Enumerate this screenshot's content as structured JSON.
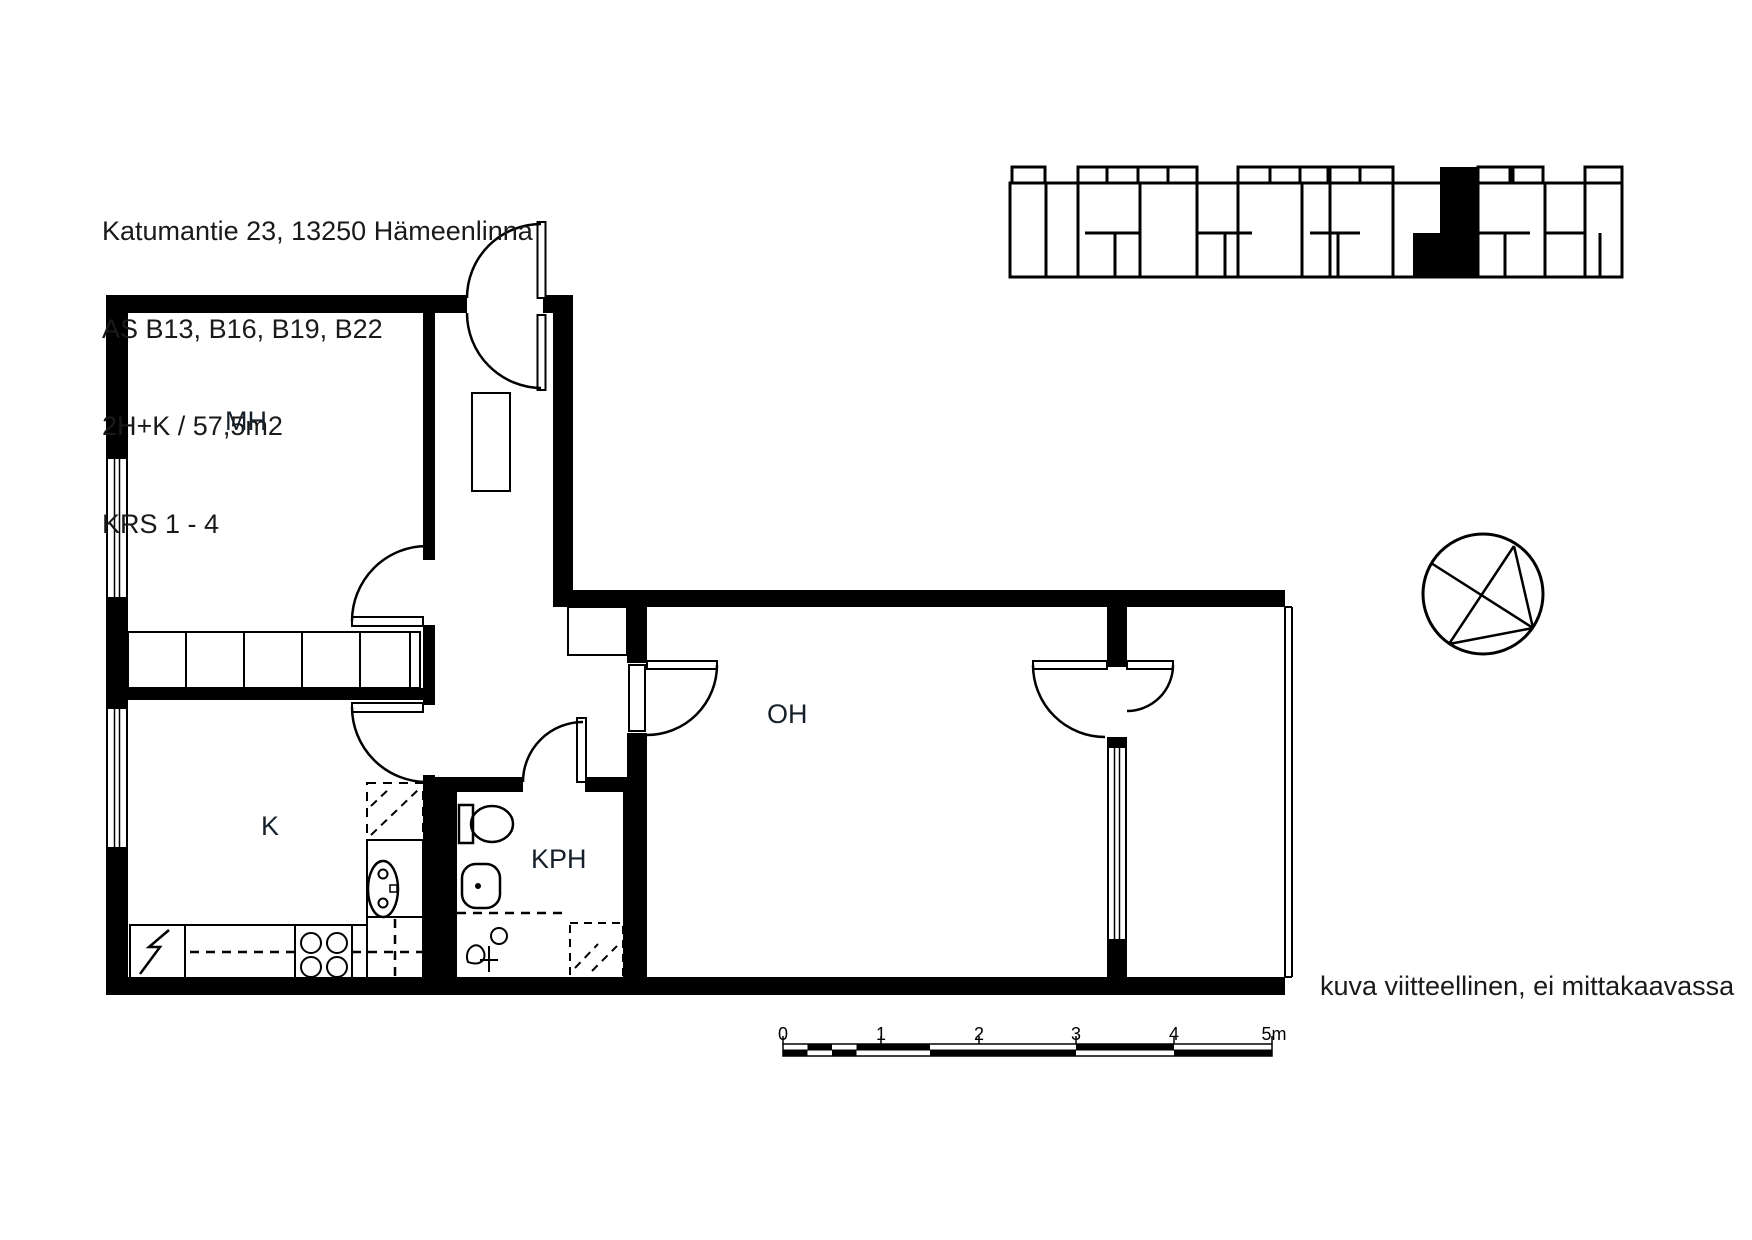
{
  "header": {
    "line1": "Katumantie 23, 13250 Hämeenlinna",
    "line2": "AS B13, B16, B19, B22",
    "line3": "2H+K / 57,5m2",
    "line4": "KRS 1 - 4"
  },
  "rooms": {
    "bedroom": "MH",
    "kitchen": "K",
    "bathroom": "KPH",
    "living_room": "OH"
  },
  "scale_bar": {
    "ticks": [
      "0",
      "1",
      "2",
      "3",
      "4",
      "5m"
    ]
  },
  "note": "kuva viitteellinen, ei mittakaavassa",
  "colors": {
    "ink": "#000000",
    "label": "#1a1a1a"
  }
}
